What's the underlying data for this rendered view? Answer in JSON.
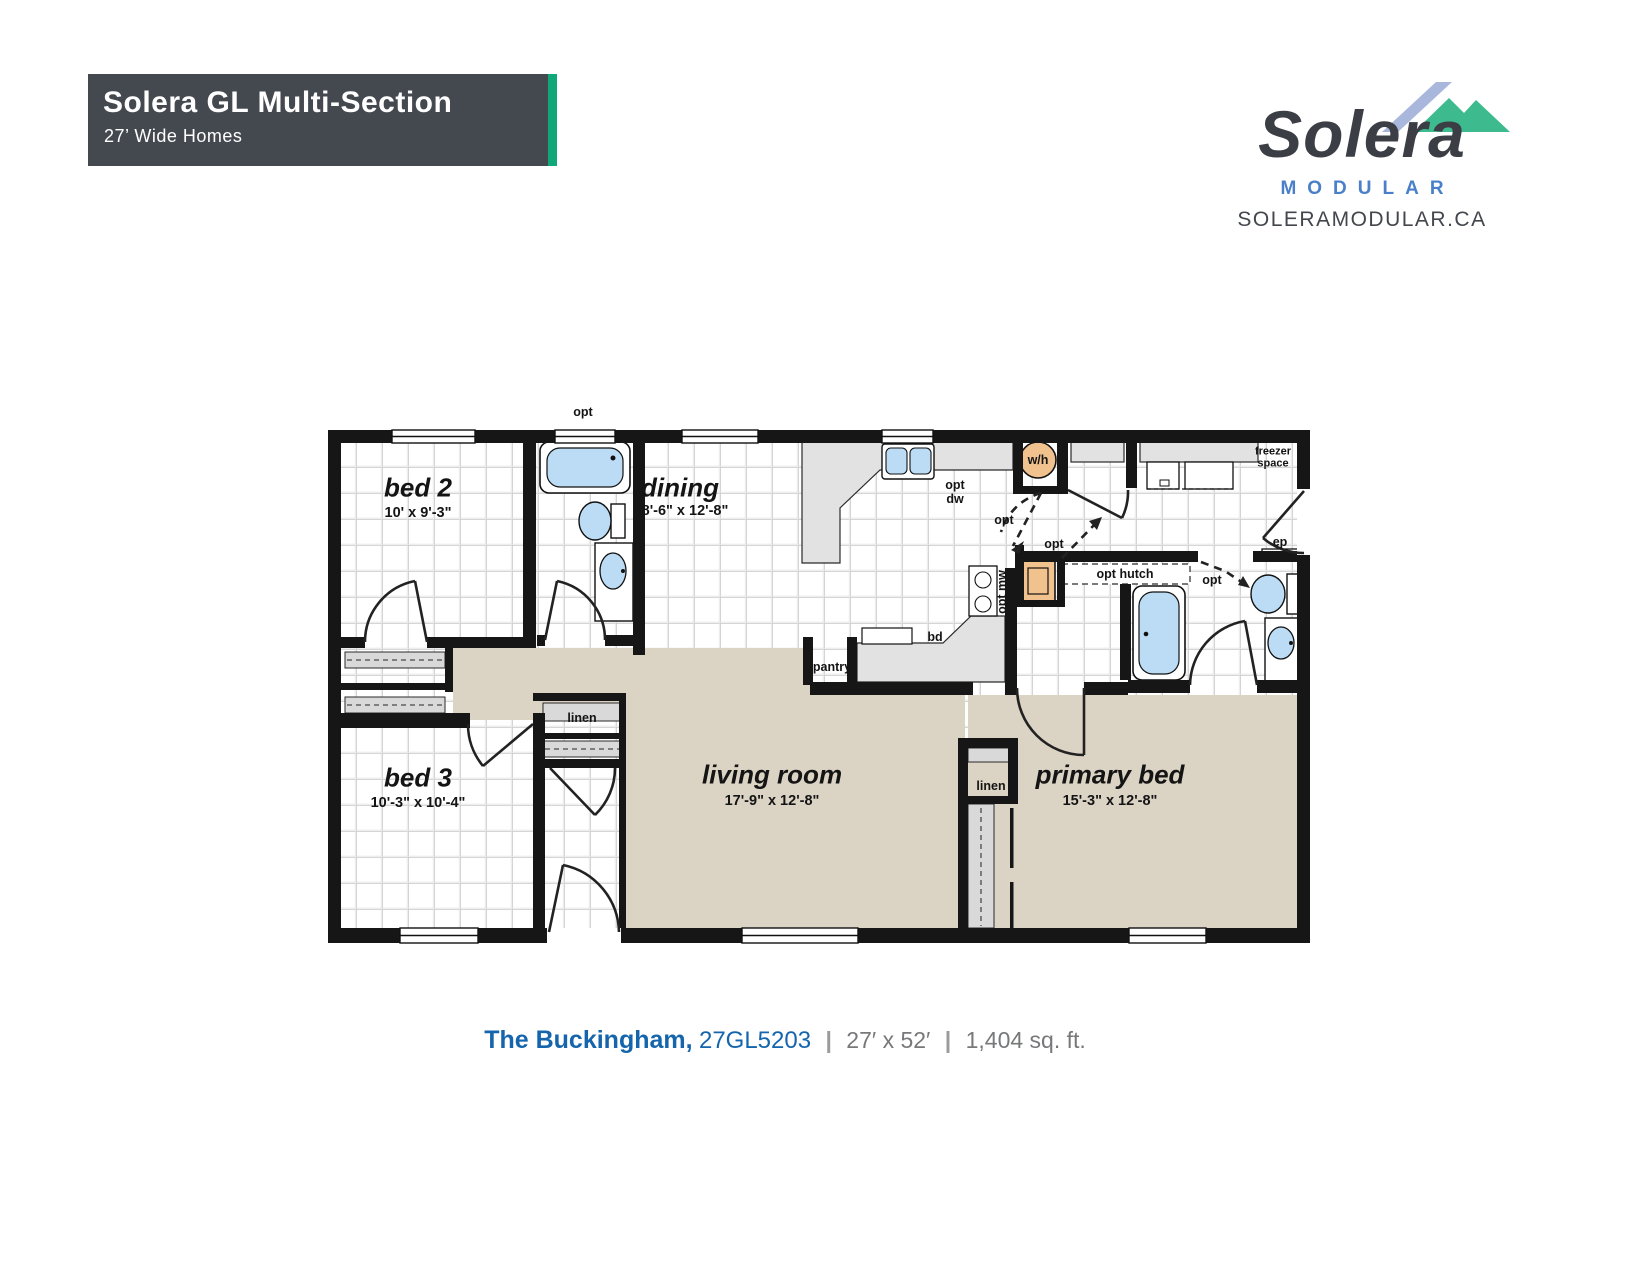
{
  "header": {
    "title": "Solera GL Multi-Section",
    "subtitle": "27’ Wide Homes"
  },
  "brand": {
    "name": "Solera",
    "tagline": "MODULAR",
    "website": "SOLERAMODULAR.CA"
  },
  "footer": {
    "plan_name": "The Buckingham,",
    "model": "27GL5203",
    "divider": "|",
    "dimensions": "27′ x 52′",
    "area": "1,404 sq. ft."
  },
  "rooms": {
    "bed2": {
      "name": "bed 2",
      "dims": "10' x 9'-3\""
    },
    "dining": {
      "name": "dining",
      "dims": "8'-6\" x 12'-8\""
    },
    "bed3": {
      "name": "bed 3",
      "dims": "10'-3\" x 10'-4\""
    },
    "living": {
      "name": "living room",
      "dims": "17'-9\" x 12'-8\""
    },
    "primary": {
      "name": "primary bed",
      "dims": "15'-3\" x 12'-8\""
    }
  },
  "labels": {
    "opt": "opt",
    "opt_dw_l1": "opt",
    "opt_dw_l2": "dw",
    "wh": "w/h",
    "freezer_l1": "freezer",
    "freezer_l2": "space",
    "ep": "ep",
    "opt_hutch": "opt hutch",
    "opt_mw": "opt mw",
    "bd": "bd",
    "pantry": "pantry",
    "linen": "linen"
  },
  "colors": {
    "accent_teal": "#10a878",
    "header_bg": "#44484f",
    "brand_blue": "#4a80c9",
    "caption_blue": "#1565ad",
    "fixture_blue": "#bcdcf5",
    "appliance_orange": "#f2c28e",
    "carpet_tan": "#dbd3c4"
  }
}
